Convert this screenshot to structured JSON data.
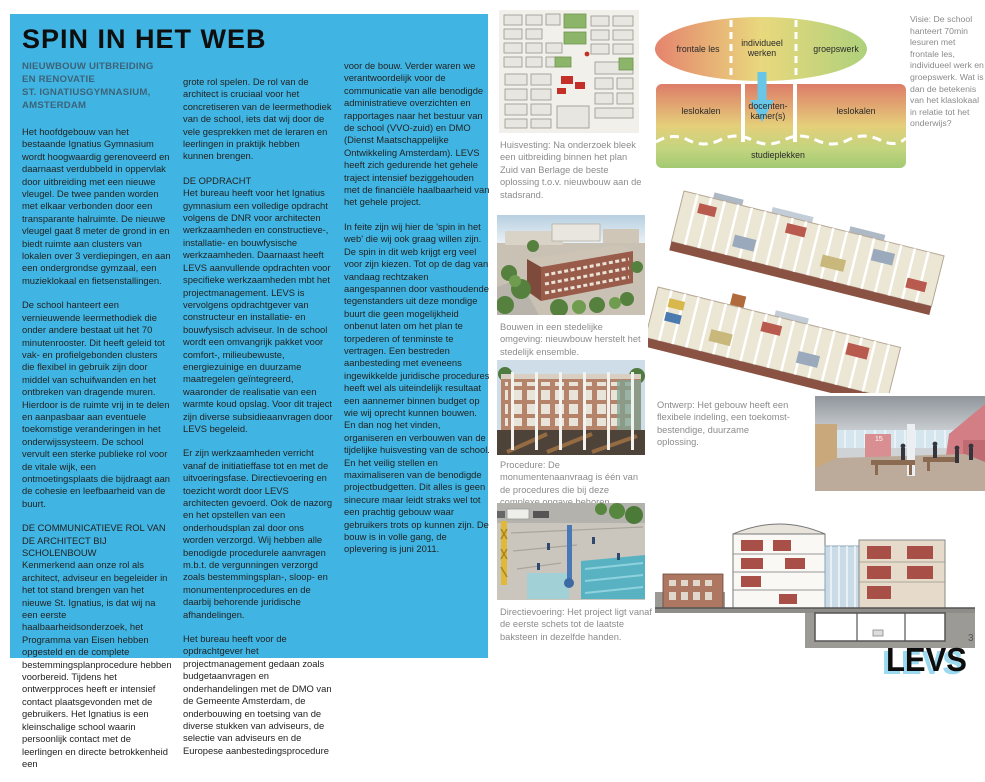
{
  "page": {
    "number": "3",
    "brand": "LEVS"
  },
  "theme": {
    "panel_cyan": "#40b5e3",
    "subtitle_blue": "#3c6378",
    "caption_gray": "#8b8b8b",
    "logo_shadow_cyan": "#9bd9f1"
  },
  "article": {
    "title": "SPIN IN HET WEB",
    "subtitle": "NIEUWBOUW UITBREIDING\nEN RENOVATIE\nST. IGNATIUSGYMNASIUM,\nAMSTERDAM",
    "columns": [
      {
        "blocks": [
          {
            "type": "para",
            "text": "Het hoofdgebouw van het bestaande Ignatius Gymnasium wordt hoogwaardig gerenoveerd en daarnaast verdubbeld in oppervlak door uitbreiding met een nieuwe vleugel. De twee panden worden met elkaar verbonden door een transparante halruimte. De nieuwe vleugel gaat 8 meter de grond in en biedt ruimte aan clusters van lokalen over 3 verdiepingen, en aan een ondergrondse gymzaal, een muzieklokaal en fietsenstallingen."
          },
          {
            "type": "para",
            "text": "De school hanteert een vernieuwende leermethodiek die onder andere bestaat uit het 70 minutenrooster. Dit heeft geleid tot vak- en profielgebonden clusters die flexibel in gebruik zijn door middel van schuifwanden en het ontbreken van dragende muren. Hierdoor is de ruimte vrij in te delen en aanpasbaar aan eventuele toekomstige veranderingen in het onderwijssysteem. De school vervult een sterke publieke rol voor de vitale wijk, een ontmoetingsplaats die bijdraagt aan de cohesie en leefbaarheid van de buurt."
          },
          {
            "type": "heading",
            "text": "DE COMMUNICATIEVE ROL VAN DE ARCHITECT BIJ SCHOLENBOUW"
          },
          {
            "type": "para",
            "text": "Kenmerkend aan onze rol als architect, adviseur en begeleider in het tot stand brengen van het nieuwe St. Ignatius, is dat wij na een eerste haalbaarheidsonderzoek, het Programma van Eisen hebben opgesteld en de complete bestemmingsplanprocedure hebben voorbereid. Tijdens het ontwerpproces heeft er intensief contact plaatsgevonden met de gebruikers. Het Ignatius is een kleinschalige school waarin persoonlijk contact met de leerlingen en directe betrokkenheid een"
          }
        ]
      },
      {
        "blocks": [
          {
            "type": "para",
            "text": "grote rol spelen. De rol van de architect is cruciaal voor het concretiseren van de leermethodiek van de school, iets dat wij door de vele gesprekken met de leraren en leerlingen in praktijk hebben kunnen brengen."
          },
          {
            "type": "heading",
            "text": "DE OPDRACHT"
          },
          {
            "type": "para",
            "text": "Het bureau heeft voor het Ignatius gymnasium een volledige opdracht volgens de DNR voor architecten werkzaamheden en constructieve-, installatie- en bouwfysische werkzaamheden. Daarnaast heeft LEVS aanvullende opdrachten voor specifieke werkzaamheden mbt het projectmanagement. LEVS is vervolgens opdrachtgever van constructeur en installatie- en bouwfysisch adviseur. In de school wordt een omvangrijk pakket voor comfort-, milieubewuste, energiezuinige en duurzame maatregelen geïntegreerd, waaronder de realisatie van een warmte koud opslag. Voor dit traject zijn diverse subsidieaanvragen door LEVS begeleid."
          },
          {
            "type": "para",
            "text": "Er zijn werkzaamheden verricht vanaf de initiatieffase tot en met de uitvoeringsfase. Directievoering en toezicht wordt door LEVS architecten gevoerd. Ook de nazorg en het opstellen van een onderhoudsplan zal door ons worden verzorgd. Wij hebben alle benodigde procedurele aanvragen m.b.t. de vergunningen verzorgd zoals bestemmingsplan-, sloop- en monumentenprocedures en de daarbij behorende juridische afhandelingen."
          },
          {
            "type": "para",
            "text": "Het bureau heeft voor de opdrachtgever het projectmanagement gedaan zoals budgetaanvragen en onderhandelingen met de DMO van de Gemeente Amsterdam, de onderbouwing en toetsing van de diverse stukken van adviseurs, de selectie van adviseurs en de Europese aanbestedingsprocedure"
          }
        ]
      },
      {
        "blocks": [
          {
            "type": "para",
            "text": "voor de bouw. Verder waren we verantwoordelijk voor de communicatie van alle benodigde administratieve overzichten en rapportages naar het bestuur van de school (VVO-zuid) en DMO (Dienst Maatschappelijke Ontwikkeling Amsterdam). LEVS heeft zich gedurende het gehele traject intensief beziggehouden met de financiële haalbaarheid van het gehele project."
          },
          {
            "type": "para",
            "text": "In feite zijn wij hier de 'spin in het web' die wij ook graag willen zijn. De spin in dit web krijgt erg veel voor zijn kiezen. Tot op de dag van vandaag rechtzaken aangespannen door vasthoudende tegenstanders uit deze mondige buurt die geen mogelijkheid onbenut laten om het plan te torpederen of tenminste te vertragen. Een bestreden aanbesteding met eveneens ingewikkelde juridische procedures heeft wel als uiteindelijk resultaat een aannemer binnen budget op wie wij oprecht kunnen bouwen. En dan nog het vinden, organiseren en verbouwen van de tijdelijke huisvesting van de school. En het veilig stellen en maximaliseren van de benodigde projectbudgetten. Dit alles is geen sinecure maar leidt straks wel tot een prachtig gebouw waar gebruikers trots op kunnen zijn. De bouw is in volle gang, de oplevering is juni 2011."
          }
        ]
      }
    ]
  },
  "diagram": {
    "ellipse": {
      "left": "frontale les",
      "middle": "individueel werken",
      "right": "groepswerk"
    },
    "bar": {
      "left": "leslokalen",
      "middle": "docenten-\nkamer(s)",
      "right": "leslokalen",
      "bottom": "studieplekken"
    },
    "colors": {
      "red": "#e5846e",
      "yellow": "#e9d87d",
      "green": "#aed17b",
      "arrow": "#68c6e6"
    }
  },
  "captions": {
    "visie": "Visie: De school hanteert 70min lesuren met frontale les, individueel werk en groepswerk. Wat is dan de betekenis van het klaslokaal in relatie tot het onderwijs?",
    "huisvesting": "Huisvesting: Na onderzoek bleek een uitbreiding binnen het plan Zuid van Berlage de beste oplossing t.o.v. nieuwbouw aan de stadsrand.",
    "bouwen": "Bouwen in een stedelijke omgeving: nieuwbouw herstelt het stedelijk ensemble.",
    "ontwerp": "Ontwerp: Het gebouw heeft een flexibele indeling, een toekomst-bestendige, duurzame oplossing.",
    "procedure": "Procedure: De monumentenaanvraag is één van de procedures die bij deze complexe opgave behoren.",
    "directievoering": "Directievoering: Het project ligt vanaf de eerste schets tot de laatste baksteen in dezelfde handen."
  },
  "figures": {
    "interior_wall_number": "15"
  }
}
